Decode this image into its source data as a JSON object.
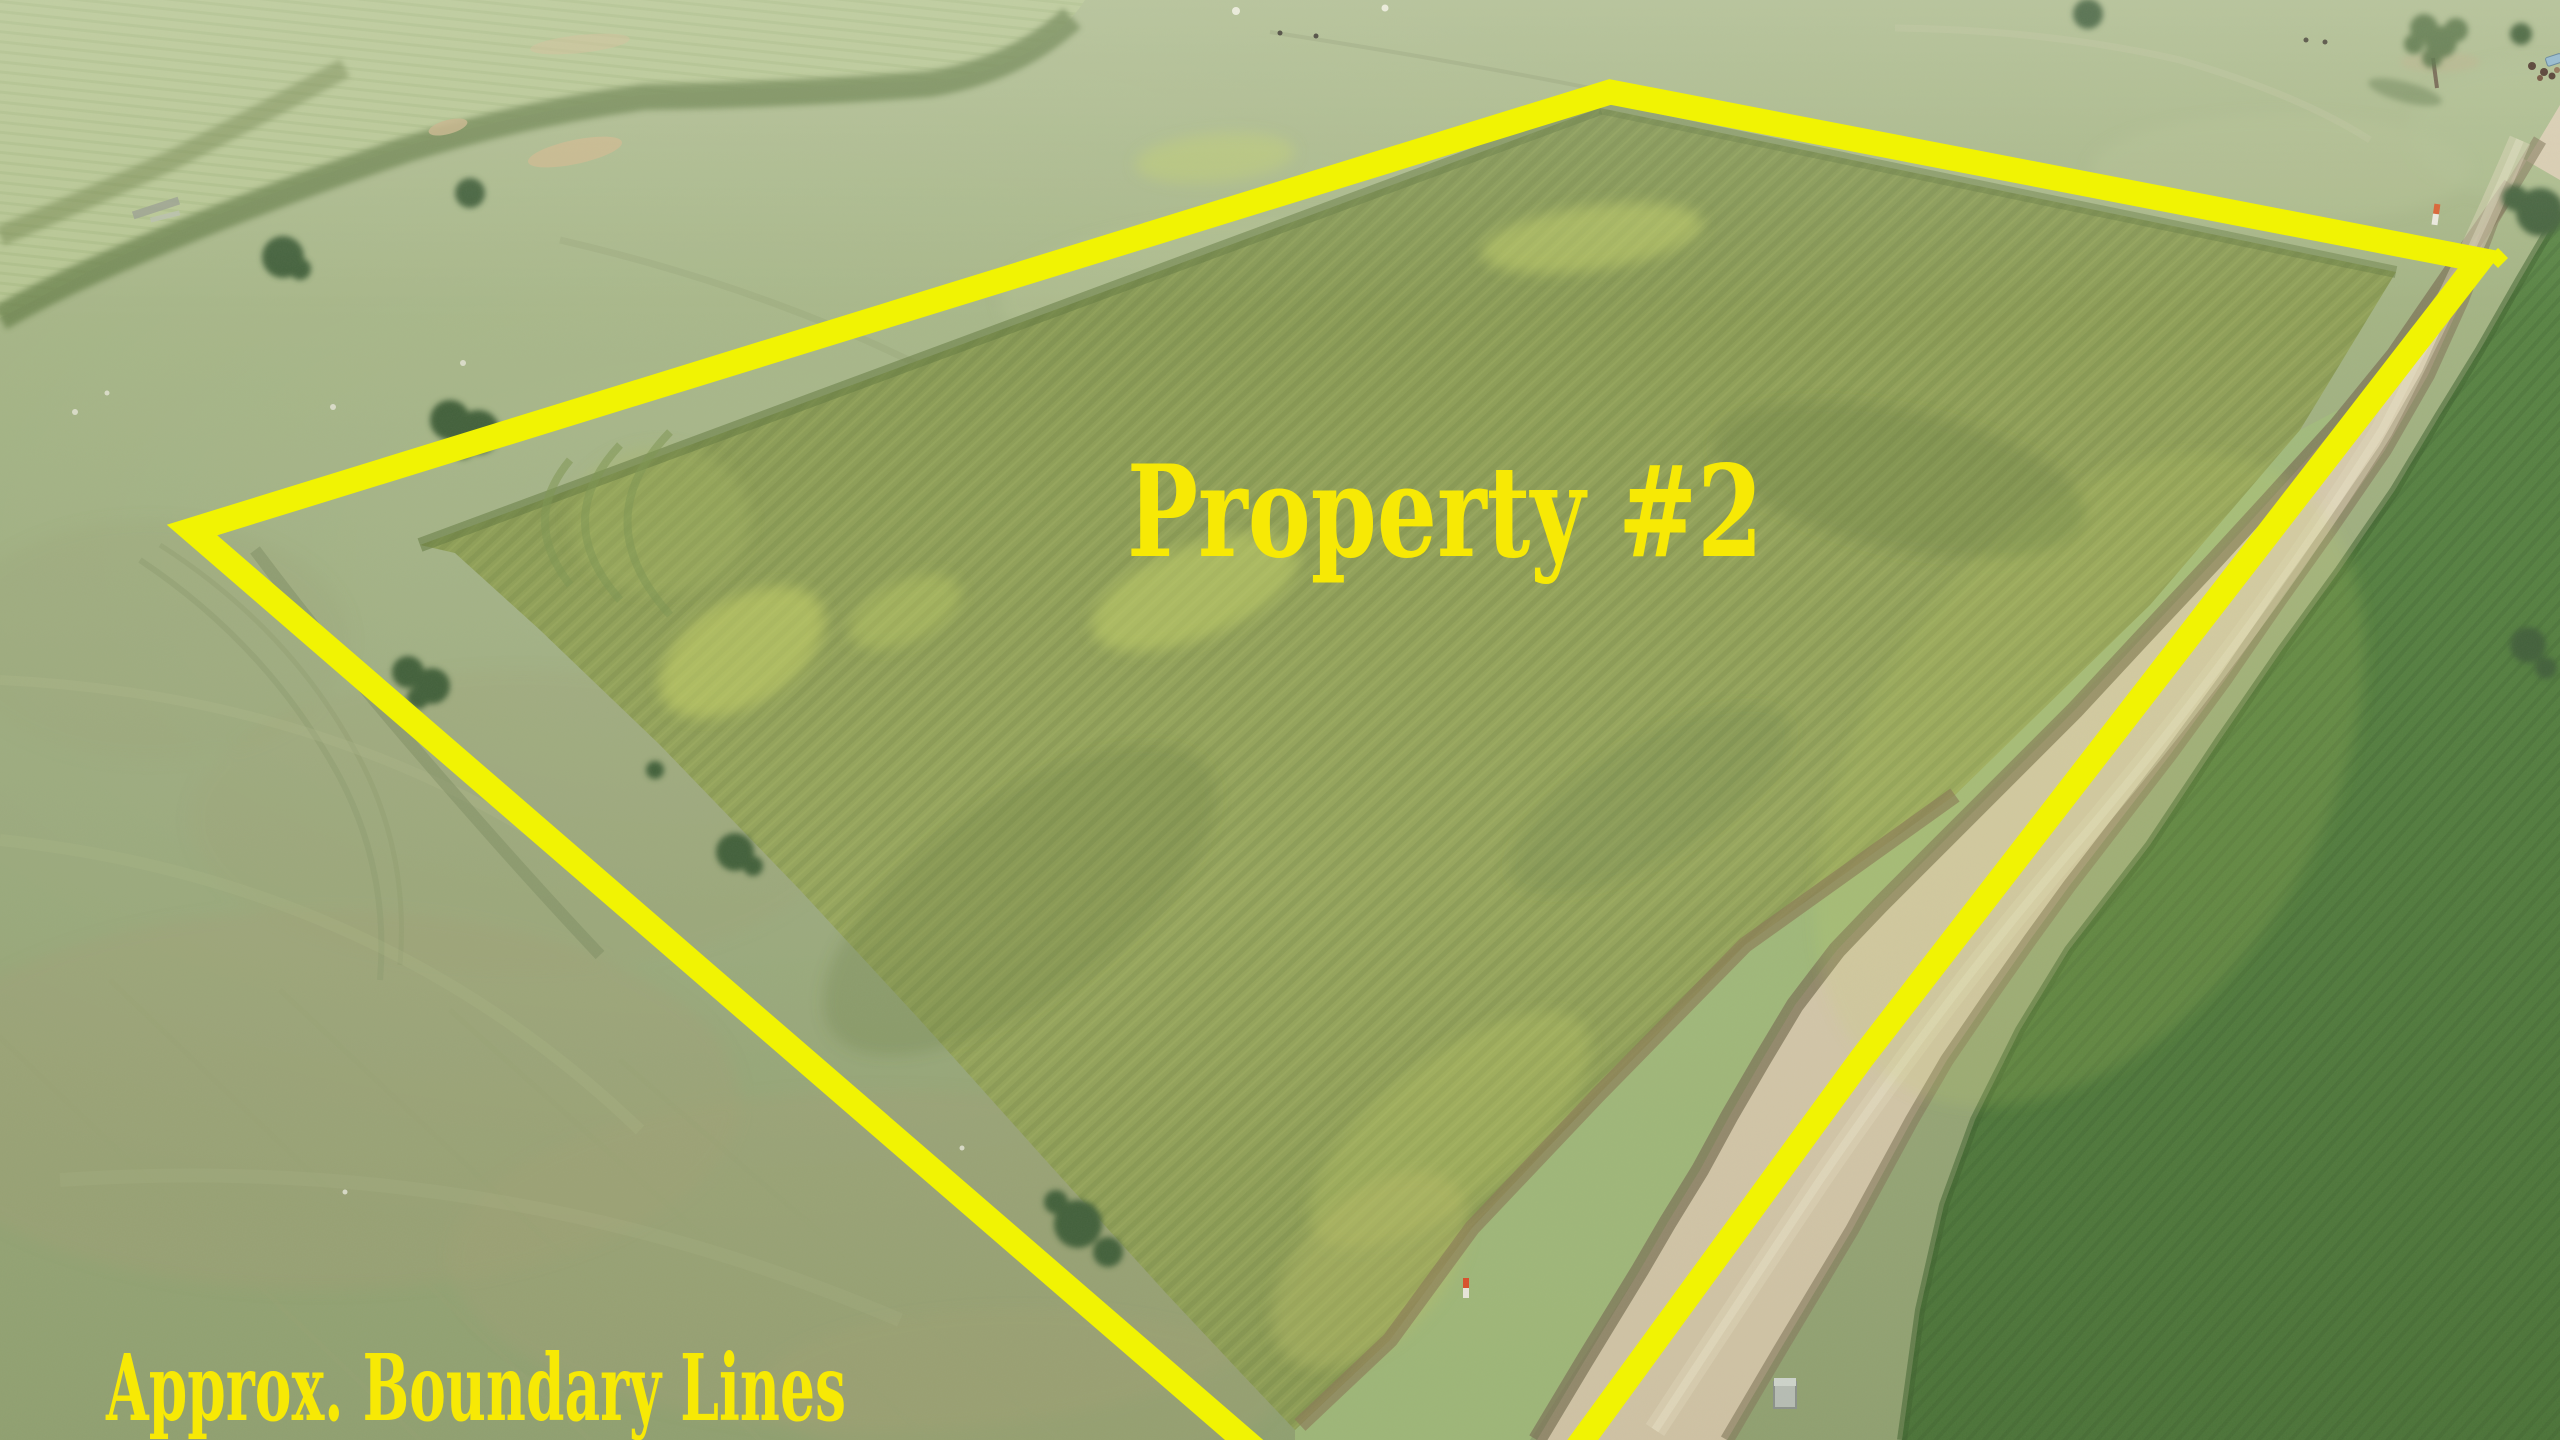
{
  "annotations": {
    "property_label": "Property #2",
    "boundary_caption": "Approx. Boundary Lines",
    "boundary_color": "#f1f303",
    "label_color": "#f7e905"
  }
}
